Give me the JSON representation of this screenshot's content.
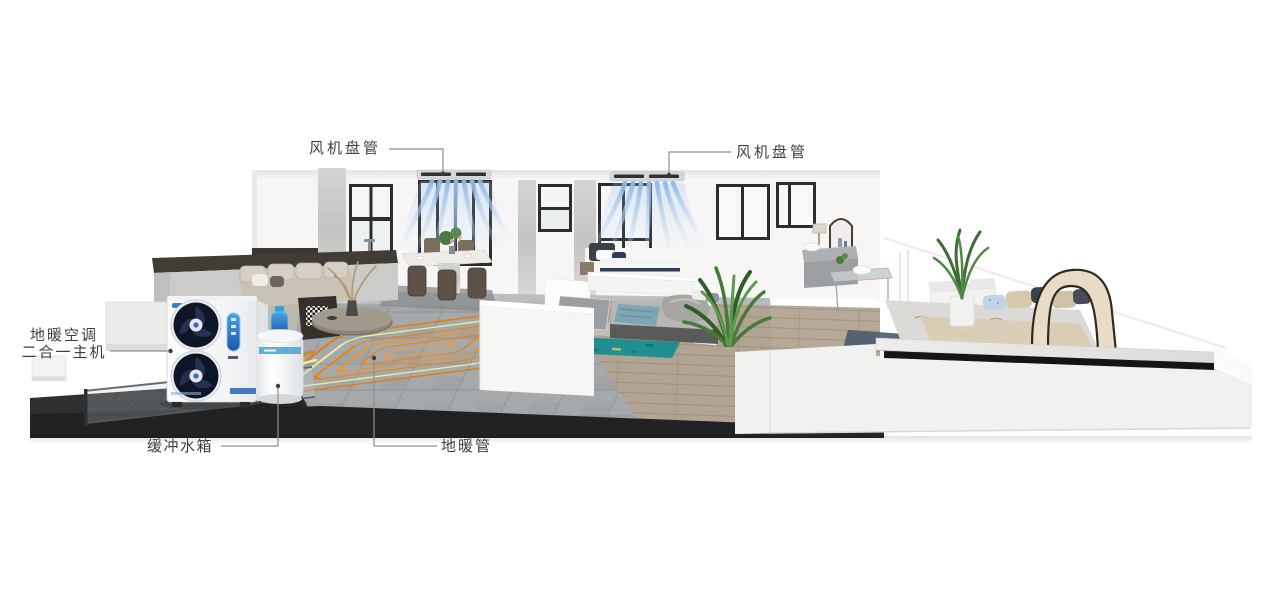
{
  "page": {
    "background": "#ffffff"
  },
  "callouts": {
    "fan_coil_left": {
      "label": "风机盘管",
      "target": "fan-coil-unit-left"
    },
    "fan_coil_right": {
      "label": "风机盘管",
      "target": "fan-coil-unit-right"
    },
    "main_unit": {
      "label_line1": "地暖空调",
      "label_line2": "二合一主机",
      "target": "heat-pump-outdoor-unit"
    },
    "buffer_tank": {
      "label": "缓冲水箱",
      "target": "buffer-water-tank"
    },
    "floor_pipe": {
      "label": "地暖管",
      "target": "floor-heating-coil"
    }
  },
  "equipment": [
    {
      "icon": "ceiling-fan-coil-icon",
      "label": "风机盘管"
    },
    {
      "icon": "heat-pump-outdoor-unit-icon",
      "label": "地暖空调二合一主机"
    },
    {
      "icon": "buffer-water-tank-icon",
      "label": "缓冲水箱"
    },
    {
      "icon": "floor-heating-coil-icon",
      "label": "地暖管"
    }
  ],
  "colors": {
    "label_text": "#3f3f3f",
    "leader_line": "#8f8f8f",
    "leader_dot": "#3c3c3c",
    "pipe_orange": "#e5861f",
    "pipe_yellow": "#eaed9b",
    "airflow_blue": "#8fb8e6",
    "platform_dark": "#2c2e30",
    "tile_gray": "#a6a9ab",
    "wall_white": "#f6f6f5",
    "accent_blue": "#2a6bc0",
    "tank_valve_blue": "#2aa3df",
    "rug_teal": "#1f8f92"
  }
}
